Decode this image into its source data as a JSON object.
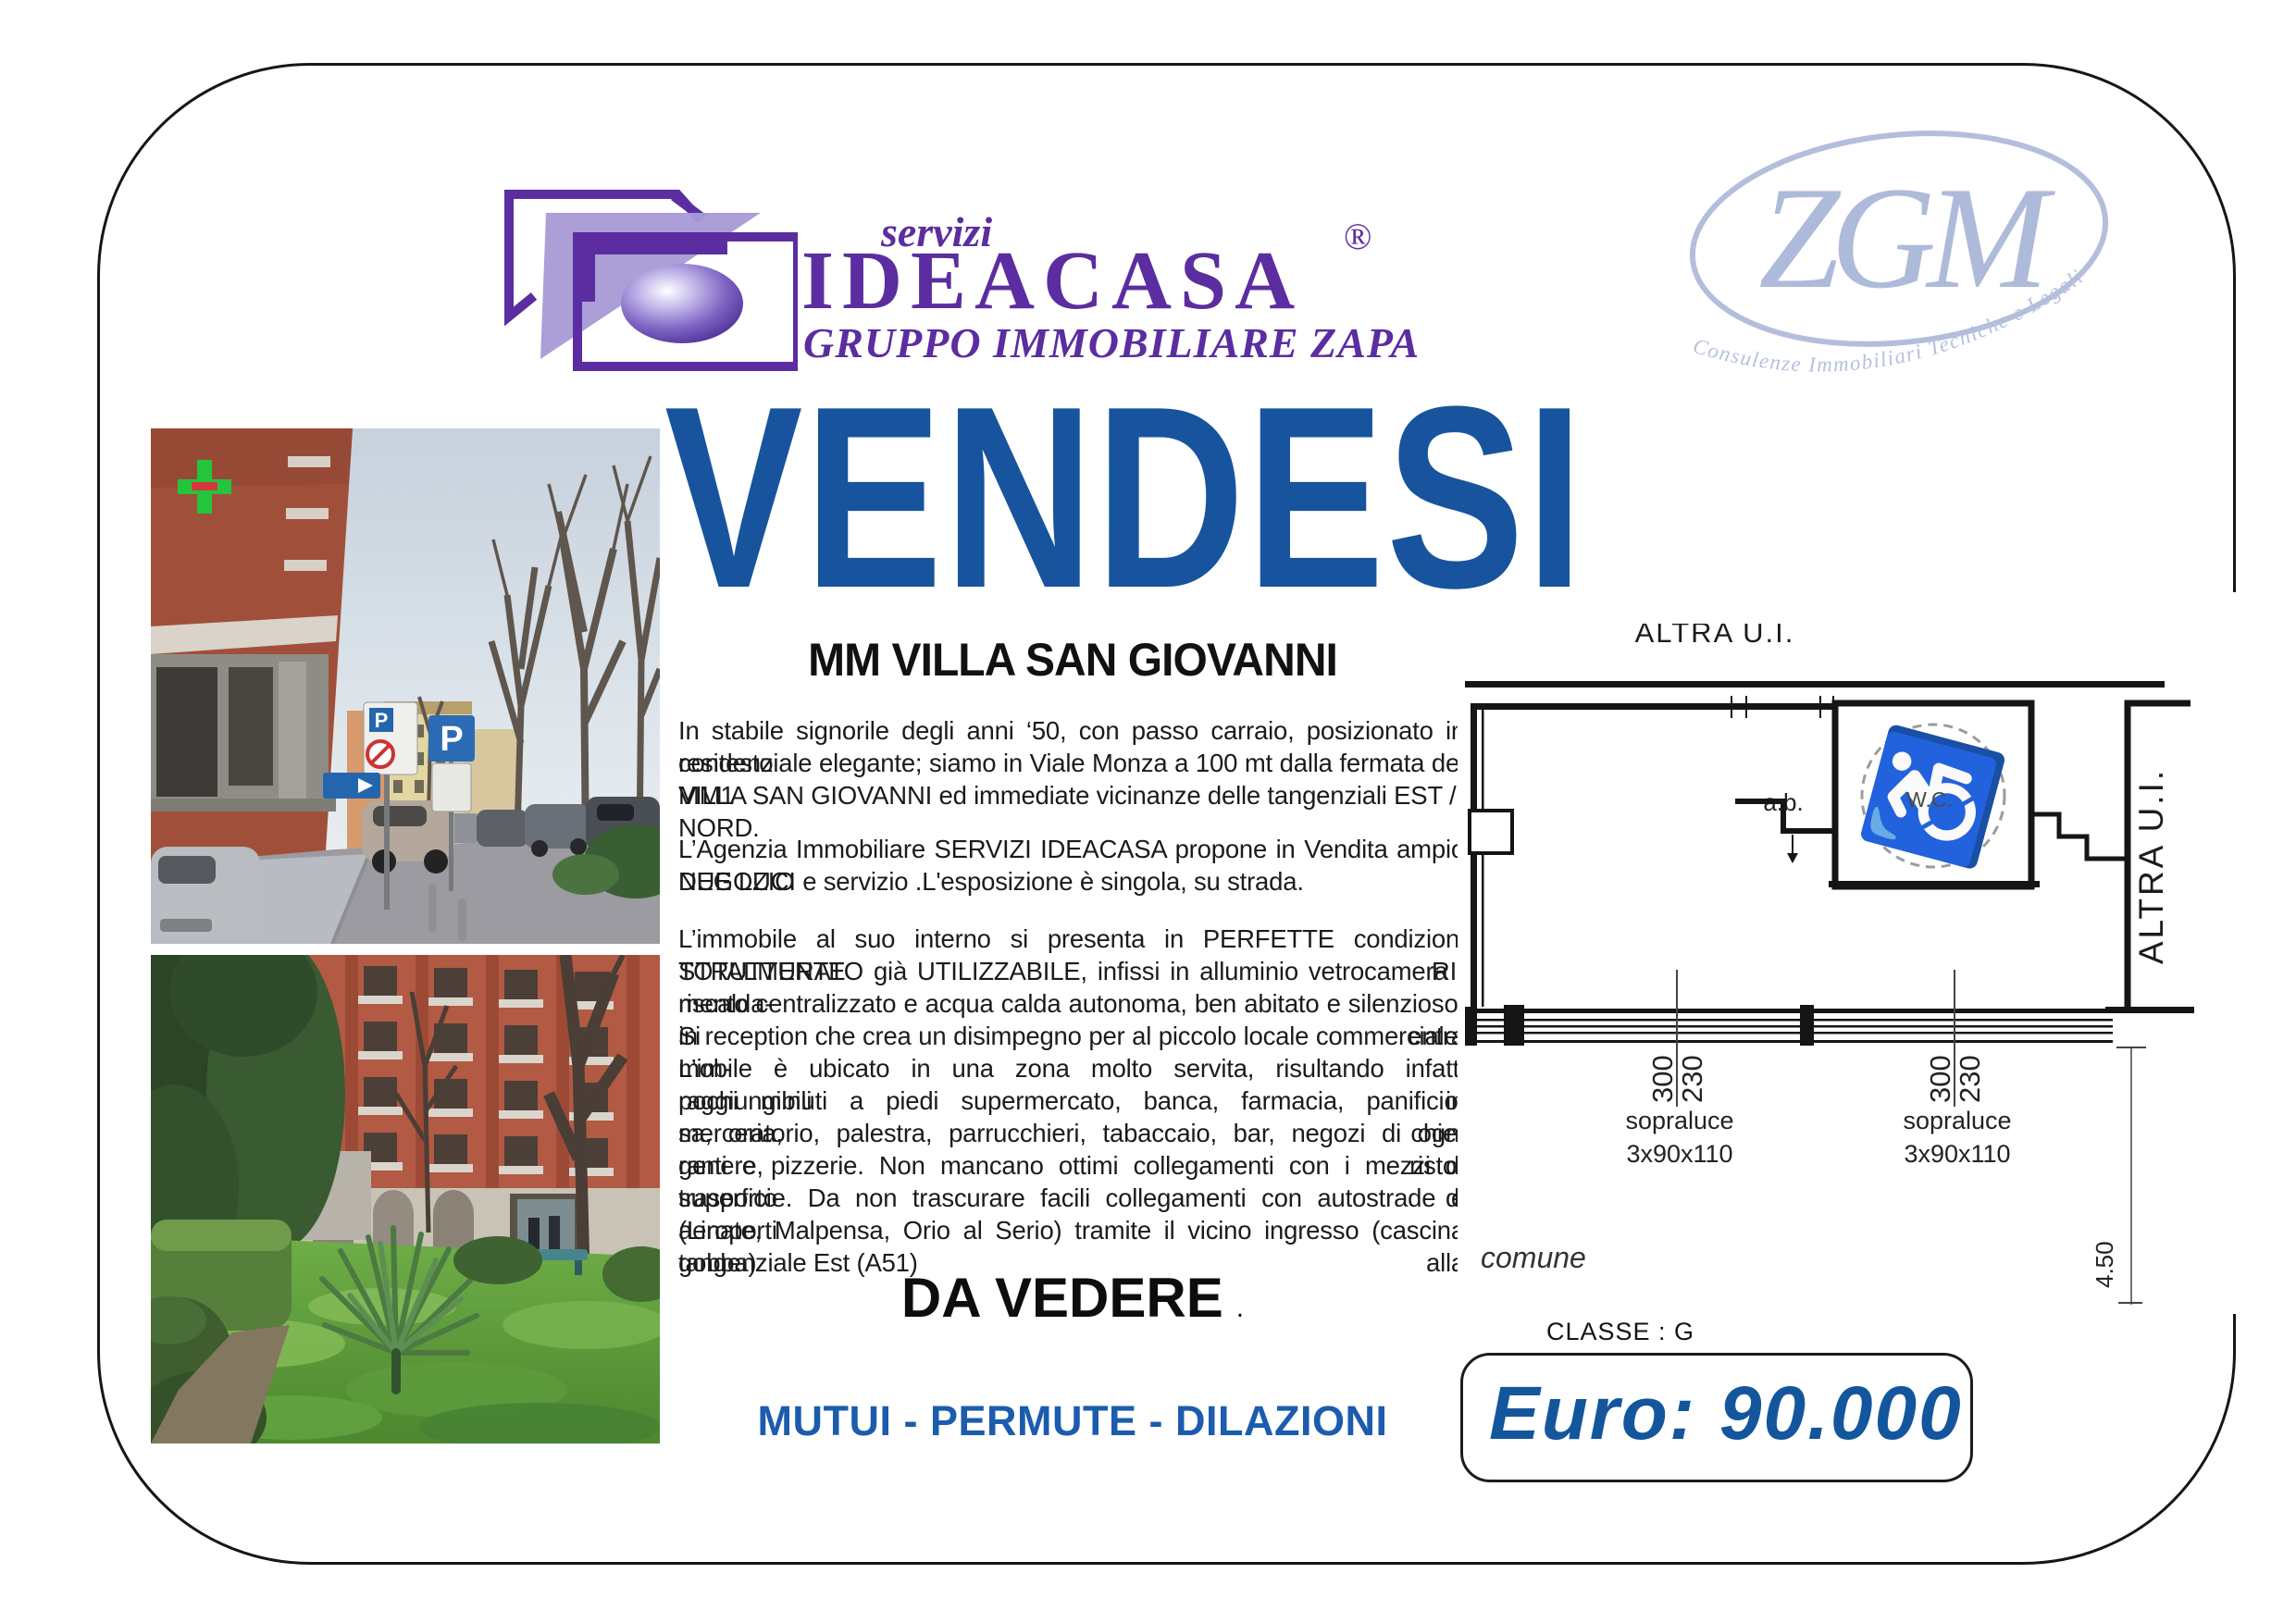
{
  "brand": {
    "servizi": "servizi",
    "name": "IDEACASA",
    "registered": "®",
    "group": "GRUPPO IMMOBILIARE ZAPA"
  },
  "zgm": {
    "letters": "ZGM",
    "tagline": "Consulenze Immobiliari Tecniche e Legali"
  },
  "headline": "VENDESI",
  "listing": {
    "location": "MM VILLA SAN GIOVANNI",
    "p1": [
      "In stabile signorile degli anni ‘50, con passo carraio, posizionato in contesto",
      "residenziale elegante; siamo in Viale Monza a 100 mt dalla fermata del MM1",
      "VILLA SAN GIOVANNI ed immediate vicinanze delle tangenziali EST / NORD."
    ],
    "p2": [
      "L’Agenzia Immobiliare SERVIZI IDEACASA propone in Vendita ampio NEGOZIO",
      "DUE LUCI e servizio .L'esposizione è singola, su strada."
    ],
    "p3": [
      "L’immobile al suo interno si presenta in PERFETTE condizioni TOTALMENTE RI-",
      "STRUTTURATO  già UTILIZZABILE, infissi in alluminio vetrocamera , riscalda-",
      "mento centralizzato e acqua calda autonoma, ben abitato e silenzioso. Si entra",
      "in reception che crea un disimpegno per al piccolo locale commerciale. L’im-",
      "mobile è ubicato in una zona molto servita, risultando infatti raggiungibili in",
      "pochi minuti a piedi supermercato, banca, farmacia, panificio, merceria, chie-",
      "sa, oratorio, palestra, parrucchieri, tabaccaio, bar, negozi  di ogni genere, risto-",
      "ranti e pizzerie. Non mancano ottimi collegamenti con i mezzi di trasporto di",
      "superficie. Da non trascurare facili collegamenti con autostrade e aeroporti",
      "(Linate, Malpensa, Orio al Serio) tramite il vicino ingresso (cascina gobba) alla",
      "tangenziale Est (A51)"
    ],
    "cta": "DA VEDERE",
    "cta_period": ".",
    "financing": "MUTUI - PERMUTE - DILAZIONI"
  },
  "floorplan": {
    "label_top": "ALTRA U.I.",
    "label_right": "ALTRA U.I.",
    "room_ab": "a.b.",
    "room_wc": "W.C.",
    "wheelchair_glyph": "♿",
    "dim_left": {
      "outer": "300",
      "inner": "230",
      "caption1": "sopraluce",
      "caption2": "3x90x110"
    },
    "dim_right": {
      "outer": "300",
      "inner": "230",
      "caption1": "sopraluce",
      "caption2": "3x90x110"
    },
    "area_label": "comune",
    "height_dim": "4.50",
    "energy_class": "CLASSE : G"
  },
  "price": "Euro: 90.000",
  "colors": {
    "brand_purple": "#5b2da0",
    "brand_purple_light": "#a89ad6",
    "headline_blue": "#17549d",
    "financing_blue": "#1b5cad",
    "price_blue": "#14569e",
    "zgm_blue": "#b3bedd"
  }
}
